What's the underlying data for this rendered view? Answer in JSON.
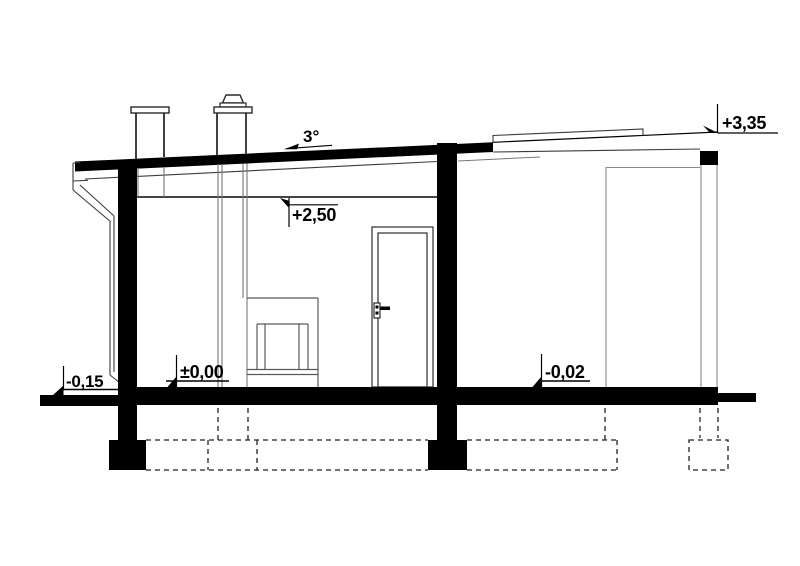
{
  "drawing": {
    "type": "architectural-cross-section",
    "roof": {
      "slope_label": "3°"
    },
    "levels": {
      "roof_top": "+3,35",
      "ceiling": "+2,50",
      "floor": "±0,00",
      "right_floor": "-0,02",
      "ground": "-0,15"
    },
    "colors": {
      "ink": "#000000",
      "paper": "#ffffff"
    }
  }
}
